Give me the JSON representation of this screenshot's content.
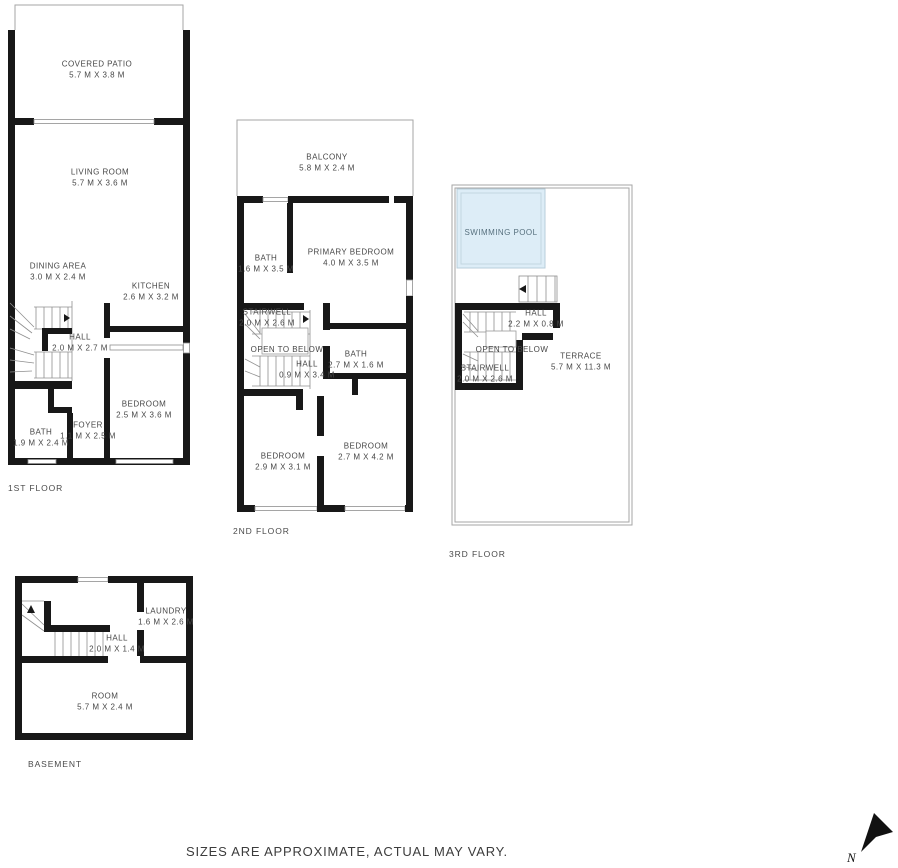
{
  "floors": [
    {
      "label": "1ST FLOOR",
      "rooms": [
        {
          "name": "COVERED PATIO",
          "dims": "5.7 M X 3.8 M"
        },
        {
          "name": "LIVING ROOM",
          "dims": "5.7 M X 3.6 M"
        },
        {
          "name": "DINING AREA",
          "dims": "3.0 M X 2.4 M"
        },
        {
          "name": "KITCHEN",
          "dims": "2.6 M X 3.2 M"
        },
        {
          "name": "HALL",
          "dims": "2.0 M X 2.7 M"
        },
        {
          "name": "BEDROOM",
          "dims": "2.5 M X 3.6 M"
        },
        {
          "name": "FOYER",
          "dims": "1.1 M X 2.5 M"
        },
        {
          "name": "BATH",
          "dims": "1.9 M X 2.4 M"
        }
      ]
    },
    {
      "label": "2ND FLOOR",
      "rooms": [
        {
          "name": "BALCONY",
          "dims": "5.8 M X 2.4 M"
        },
        {
          "name": "BATH",
          "dims": "1.6 M X 3.5 M"
        },
        {
          "name": "PRIMARY BEDROOM",
          "dims": "4.0 M X 3.5 M"
        },
        {
          "name": "STAIRWELL",
          "dims": "2.0 M X 2.6 M"
        },
        {
          "name": "OPEN TO BELOW",
          "dims": ""
        },
        {
          "name": "HALL",
          "dims": "0.9 M X 3.4 M"
        },
        {
          "name": "BATH",
          "dims": "2.7 M X 1.6 M"
        },
        {
          "name": "BEDROOM",
          "dims": "2.9 M X 3.1 M"
        },
        {
          "name": "BEDROOM",
          "dims": "2.7 M X 4.2 M"
        }
      ]
    },
    {
      "label": "3RD FLOOR",
      "rooms": [
        {
          "name": "SWIMMING POOL",
          "dims": ""
        },
        {
          "name": "HALL",
          "dims": "2.2 M X 0.8 M"
        },
        {
          "name": "OPEN TO BELOW",
          "dims": ""
        },
        {
          "name": "STAIRWELL",
          "dims": "2.0 M X 2.6 M"
        },
        {
          "name": "TERRACE",
          "dims": "5.7 M X 11.3 M"
        }
      ]
    },
    {
      "label": "BASEMENT",
      "rooms": [
        {
          "name": "LAUNDRY",
          "dims": "1.6 M X 2.6 M"
        },
        {
          "name": "HALL",
          "dims": "2.0 M X 1.4 M"
        },
        {
          "name": "ROOM",
          "dims": "5.7 M X 2.4 M"
        }
      ]
    }
  ],
  "footer": {
    "disclaimer": "SIZES ARE APPROXIMATE, ACTUAL MAY VARY."
  },
  "compass": {
    "label": "N",
    "icon": "north-arrow-icon"
  },
  "colors": {
    "wall": "#181818",
    "thin_outline": "#a6a6a6",
    "text": "#474747",
    "pool_fill": "#ddedf7",
    "pool_border": "#b8cedb",
    "pool_text": "#57707e"
  }
}
